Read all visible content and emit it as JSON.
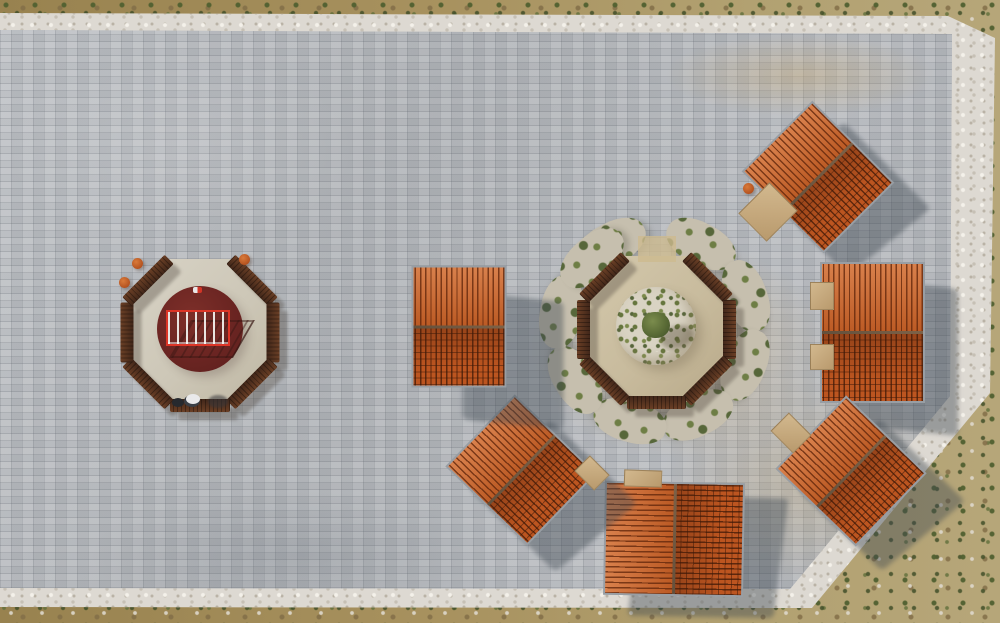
{
  "meta": {
    "domain": "natural-image",
    "description": "Aerial drone photograph of a light-grey stone-paved plaza bordered by white rock walls in tan scrubland. Six square pavilions with orange clay-tile gable roofs ring an octagonal timber bench court with a circular gravel planting bed and small tree. A second octagonal bench court to the west has a dark red painted circle with a bright red railing platform; a person with a dog stands at its southern edge. The plaza's south-east corner is cut diagonally.",
    "sun_direction": "upper-left, shadows cast to lower-right"
  },
  "palette": {
    "pavement": "#b5b8bc",
    "stone_border": "#ddd9d2",
    "terrain": "#a7905f",
    "shrub_green": "#57673a",
    "roof_bright": "#cf6529",
    "roof_dark": "#bc5520",
    "roof_trim": "#989ea4",
    "bench_brown": "#4f2f1f",
    "red_circle": "#6b2522",
    "railing_red": "#dd3527",
    "gravel": "#d9d3c3",
    "shadow": "#3e4852"
  },
  "plaza": {
    "pavement_polygon": "0,30 952,34 950,396 790,589 0,588",
    "border_polygon": "0,13 948,16 995,38 990,393 812,608 0,607"
  },
  "pavilions": [
    {
      "id": "pavilion-north",
      "x": 818,
      "y": 177,
      "w": 116,
      "h": 100,
      "rot": 45,
      "sx": 28,
      "sy": 22
    },
    {
      "id": "pavilion-east",
      "x": 872,
      "y": 332,
      "w": 141,
      "h": 105,
      "rot": 90,
      "sx": 30,
      "sy": 24
    },
    {
      "id": "pavilion-southeast",
      "x": 851,
      "y": 471,
      "w": 112,
      "h": 102,
      "rot": 44,
      "sx": 30,
      "sy": 24
    },
    {
      "id": "pavilion-south",
      "x": 674,
      "y": 539,
      "w": 140,
      "h": 114,
      "rot": 1,
      "sx": 34,
      "sy": 18
    },
    {
      "id": "pavilion-southwest",
      "x": 521,
      "y": 470,
      "w": 114,
      "h": 100,
      "rot": 44,
      "sx": 32,
      "sy": 26
    },
    {
      "id": "pavilion-west",
      "x": 459,
      "y": 326,
      "w": 122,
      "h": 95,
      "rot": 90,
      "sx": 54,
      "sy": 34
    }
  ],
  "bench_rings": [
    {
      "id": "west-court-ring",
      "cx": 200,
      "cy": 332,
      "r": 73,
      "seg_len": 60,
      "seg_th": 13,
      "angles": [
        45,
        90,
        135,
        180,
        225,
        270,
        315
      ]
    },
    {
      "id": "garden-court-ring",
      "cx": 656,
      "cy": 329,
      "r": 73,
      "seg_len": 59,
      "seg_th": 13,
      "angles": [
        45,
        90,
        135,
        180,
        225,
        270,
        315
      ]
    }
  ],
  "veg_ring": {
    "cx": 656,
    "cy": 329,
    "r": 96,
    "patch_w": 74,
    "patch_h": 42,
    "angles": [
      -28,
      28,
      70,
      112,
      154,
      196,
      238,
      280,
      318
    ]
  },
  "decks": [
    {
      "left": 748,
      "top": 190,
      "w": 38,
      "h": 42,
      "rot": 45
    },
    {
      "left": 810,
      "top": 282,
      "w": 22,
      "h": 26,
      "rot": 0
    },
    {
      "left": 810,
      "top": 344,
      "w": 22,
      "h": 24,
      "rot": 0
    },
    {
      "left": 775,
      "top": 420,
      "w": 30,
      "h": 24,
      "rot": 45
    },
    {
      "left": 624,
      "top": 470,
      "w": 36,
      "h": 15,
      "rot": 2
    },
    {
      "left": 578,
      "top": 462,
      "w": 26,
      "h": 20,
      "rot": 45
    }
  ],
  "pots": [
    {
      "x": 137,
      "y": 263
    },
    {
      "x": 124,
      "y": 282
    },
    {
      "x": 244,
      "y": 259
    },
    {
      "x": 748,
      "y": 188
    }
  ]
}
